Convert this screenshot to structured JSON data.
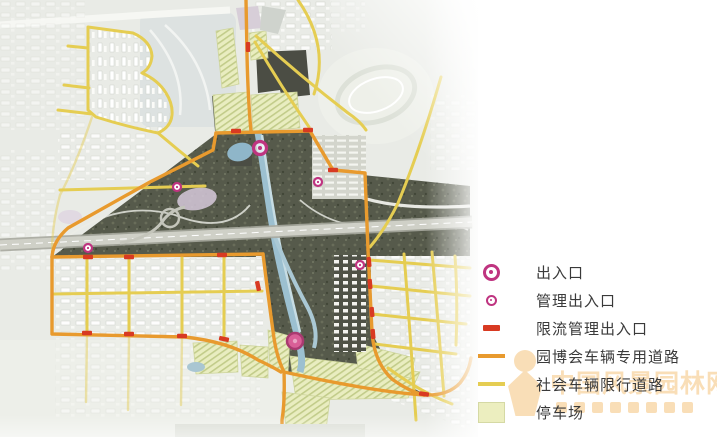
{
  "legend": {
    "items": [
      {
        "id": "main-entrance",
        "label": "出入口"
      },
      {
        "id": "management-entrance",
        "label": "管理出入口"
      },
      {
        "id": "flow-limit-entrance",
        "label": "限流管理出入口"
      },
      {
        "id": "expo-vehicle-road",
        "label": "园博会车辆专用道路"
      },
      {
        "id": "public-vehicle-road",
        "label": "社会车辆限行道路"
      },
      {
        "id": "parking-lot",
        "label": "停车场"
      }
    ]
  },
  "watermark": {
    "text": "中国风景园林网"
  },
  "colors": {
    "entrance_magenta": "#bf3480",
    "flow_limit_red": "#d83a22",
    "expo_road_orange": "#e89a2e",
    "public_road_yellow": "#e5cd52",
    "parking_fill": "#eceebf",
    "parking_border": "#d5d9a4",
    "legend_text": "#3a3a3a",
    "watermark_orange": "#f4be72",
    "park_dark": "#565a4b",
    "river_blue": "#9cc0d0",
    "solid_entrance_pink": "#d95f97"
  },
  "map": {
    "main_entrances": [
      {
        "x": 260,
        "y": 148,
        "style": "ring"
      },
      {
        "x": 295,
        "y": 341,
        "style": "solid"
      }
    ],
    "management_entrances": [
      {
        "x": 177,
        "y": 187
      },
      {
        "x": 318,
        "y": 182
      },
      {
        "x": 88,
        "y": 248
      },
      {
        "x": 360,
        "y": 265
      }
    ],
    "flow_limit_markers": [
      [
        248,
        47,
        90
      ],
      [
        236,
        131,
        0
      ],
      [
        308,
        130,
        0
      ],
      [
        333,
        170,
        0
      ],
      [
        88,
        257,
        0
      ],
      [
        129,
        257,
        0
      ],
      [
        222,
        255,
        0
      ],
      [
        87,
        333,
        0
      ],
      [
        129,
        334,
        0
      ],
      [
        182,
        336,
        0
      ],
      [
        224,
        339,
        12
      ],
      [
        258,
        286,
        78
      ],
      [
        369,
        262,
        85
      ],
      [
        370,
        284,
        85
      ],
      [
        372,
        312,
        85
      ],
      [
        373,
        334,
        85
      ],
      [
        424,
        394,
        8
      ]
    ]
  }
}
